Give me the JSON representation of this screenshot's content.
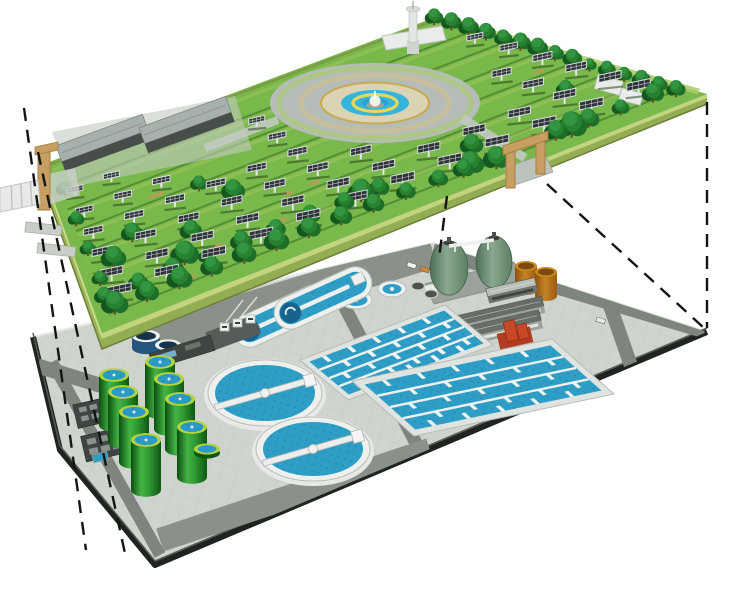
{
  "scene": {
    "width": 740,
    "height": 589,
    "background": "#ffffff",
    "description": "Exploded axonometric illustration of a ground-level park with solar panel arrays, trees and a central fountain plaza sitting above an underground wastewater treatment plant; dashed projection lines connect the two decks."
  },
  "palette": {
    "grass": "#79b84a",
    "grass_stripe": "#2a5a1c",
    "lime": "#a9cb67",
    "hedge_edge": "#7d9b44",
    "wall_top": "#c9da8a",
    "wall_face": "#9db556",
    "wall_front": "#93ad52",
    "wall_shadow": "#6a7f39",
    "panel": "#2e3338",
    "panel_grid": "#c8cdd1",
    "panel_frame": "#d9dde0",
    "panel_post": "#e6e9ea",
    "panel_shadow": "#1e3d14",
    "tree_dark": "#15581f",
    "tree_mid": "#1d6e28",
    "tree_light": "#27822f",
    "tree_top": "#339441",
    "trunk": "#6d4a28",
    "plaza_pave": "#b6bdb9",
    "plaza_inner": "#dbd4b4",
    "plaza_tan": "#c9a94e",
    "plaza_ring": "#cbbf94",
    "water_bright": "#35b5dc",
    "water": "#2f9ec6",
    "water_dark": "#17638c",
    "yellow": "#e9d75a",
    "shed_roof": "#a7b0ac",
    "shed_wall": "#474d49",
    "white_struct": "#e9ece9",
    "struct_stroke": "#c0c6c0",
    "gate_tan": "#c79f63",
    "gate_dark": "#a57e41",
    "pave": "#d0d4cf",
    "road": "#7d857d",
    "apron": "#8a918a",
    "edge_black": "#202420",
    "tank_white": "#eef0ee",
    "navy": "#24567e",
    "navy_top": "#16334d",
    "block_frame": "#e0e4e0",
    "tab": "#f2f4f2",
    "cyl_rim": "#b5d33f",
    "cyl_water": "#2a9ac8",
    "dark_bldg": "#3f4542",
    "skylight": "#98a19c",
    "glint": "#7cc4de",
    "gray_roof": "#676d67",
    "gray_wall": "#9aa19a",
    "red_bldg": "#c84828",
    "red_dark": "#8f3015",
    "machinery_pad": "#565d58",
    "dash": "#141414",
    "tan_rail": "#b99a57",
    "ramp": "#c9cec9",
    "path_gray": "#c3c9c2"
  },
  "upper_level": {
    "label": "surface park with solar farm",
    "platform": {
      "corners": {
        "west": [
          41,
          165
        ],
        "north": [
          436,
          17
        ],
        "east": [
          707,
          94
        ],
        "south": [
          102,
          333
        ]
      },
      "wall_height": 16
    },
    "solar_panels": {
      "rows": [
        0.1,
        0.23,
        0.36,
        0.49,
        0.62,
        0.75,
        0.86
      ],
      "u_start": 0.045,
      "u_end": 0.96,
      "u_step": 0.082,
      "seed": 7
    },
    "exclusions": {
      "plaza_ellipse": {
        "cx": 375,
        "cy": 103,
        "rx": 128,
        "ry": 56
      },
      "rects": [
        [
          46,
          104,
          244,
          180
        ],
        [
          370,
          0,
          460,
          64
        ]
      ]
    },
    "plaza": {
      "cx": 375,
      "cy": 103,
      "outer_rx": 105,
      "outer_ry": 40,
      "hedge_rx": 96,
      "hedge_ry": 35,
      "ring_rx": 74,
      "ring_ry": 28,
      "inner_rx": 54,
      "inner_ry": 20.5,
      "blue_rx": 34,
      "blue_ry": 13,
      "yellow_rx": 22,
      "yellow_ry": 8.4,
      "core_rx": 13,
      "core_ry": 5
    },
    "paths": [
      {
        "x1": 462,
        "y1": 118,
        "x2": 525,
        "y2": 158,
        "w": 9
      },
      {
        "x1": 278,
        "y1": 120,
        "x2": 205,
        "y2": 148,
        "w": 8
      }
    ],
    "sheds": [
      {
        "cx": 105,
        "cy": 146,
        "len": 92,
        "wid": 17,
        "wallH": 10,
        "angle": -20
      },
      {
        "cx": 188,
        "cy": 128,
        "len": 92,
        "wid": 17,
        "wallH": 10,
        "angle": -20
      }
    ],
    "shed_pad": [
      [
        52,
        132
      ],
      [
        235,
        96
      ],
      [
        252,
        150
      ],
      [
        72,
        187
      ]
    ],
    "tower": {
      "base": [
        407,
        40,
        12,
        14
      ],
      "shaft": [
        409,
        10,
        8,
        32
      ],
      "top": [
        413,
        9,
        7,
        3
      ]
    },
    "white_building": [
      [
        382,
        36
      ],
      [
        442,
        26
      ],
      [
        446,
        40
      ],
      [
        386,
        50
      ]
    ],
    "white_boxes": [
      {
        "x": 598,
        "y": 75,
        "w": 26,
        "h": 14,
        "angle": 15
      },
      {
        "x": 622,
        "y": 88,
        "w": 22,
        "h": 12,
        "angle": 15
      }
    ],
    "trees": {
      "back_row": {
        "u": 0.975,
        "v0": 0.03,
        "v1": 0.95,
        "step": 0.065,
        "r": 8
      },
      "left_edge": {
        "u": 0.025,
        "vs": [
          0.2,
          0.38,
          0.56,
          0.74
        ],
        "r": 8
      },
      "front_rows": [
        {
          "v": 0.92,
          "u0": 0.03,
          "u1": 0.66,
          "step": 0.055,
          "r": 11
        },
        {
          "v": 0.92,
          "u0": 0.78,
          "u1": 0.96,
          "step": 0.055,
          "r": 10
        },
        {
          "v": 0.845,
          "u0": 0.02,
          "u1": 0.5,
          "step": 0.06,
          "r": 9
        }
      ],
      "per_row": 3
    },
    "gates": {
      "left": {
        "post": [
          38,
          150,
          12,
          60
        ],
        "cap": [
          [
            35,
            147
          ],
          [
            58,
            142
          ],
          [
            58,
            150
          ],
          [
            35,
            155
          ]
        ]
      },
      "right": {
        "postA": [
          506,
          152,
          9,
          36
        ],
        "postB": [
          536,
          138,
          9,
          36
        ],
        "beam": [
          [
            503,
            146
          ],
          [
            548,
            131
          ],
          [
            548,
            140
          ],
          [
            503,
            155
          ]
        ],
        "ramp": [
          [
            504,
            168
          ],
          [
            545,
            154
          ],
          [
            553,
            172
          ],
          [
            512,
            186
          ]
        ]
      }
    },
    "exit_road": [
      [
        0,
        188
      ],
      [
        38,
        180
      ],
      [
        40,
        204
      ],
      [
        0,
        212
      ]
    ],
    "ramps": [
      {
        "x": 26,
        "y": 222,
        "w": 36,
        "h": 10,
        "angle": 6
      },
      {
        "x": 38,
        "y": 243,
        "w": 38,
        "h": 10,
        "angle": 6
      }
    ],
    "gate_pad": [
      [
        42,
        175
      ],
      [
        75,
        168
      ],
      [
        80,
        195
      ],
      [
        48,
        205
      ]
    ]
  },
  "lower_level": {
    "label": "underground wastewater treatment plant",
    "platform": {
      "corners": [
        [
          33,
          337
        ],
        [
          433,
          243
        ],
        [
          707,
          332
        ],
        [
          155,
          565
        ],
        [
          60,
          450
        ]
      ]
    },
    "roads": [
      {
        "x1": 150,
        "y1": 338,
        "x2": 433,
        "y2": 252,
        "w": 32,
        "kind": "apron"
      },
      {
        "x1": 433,
        "y1": 250,
        "x2": 705,
        "y2": 331,
        "w": 15,
        "kind": "road"
      },
      {
        "x1": 52,
        "y1": 362,
        "x2": 160,
        "y2": 555,
        "w": 12,
        "kind": "road"
      },
      {
        "x1": 38,
        "y1": 366,
        "x2": 125,
        "y2": 393,
        "w": 15,
        "kind": "road"
      },
      {
        "x1": 340,
        "y1": 298,
        "x2": 430,
        "y2": 470,
        "w": 13,
        "kind": "road"
      },
      {
        "x1": 160,
        "y1": 540,
        "x2": 430,
        "y2": 450,
        "w": 24,
        "kind": "apron"
      },
      {
        "x1": 608,
        "y1": 300,
        "x2": 650,
        "y2": 420,
        "w": 14,
        "kind": "road"
      }
    ],
    "oxidation_ditches": [
      {
        "cx": 282,
        "cy": 316,
        "len": 104,
        "wid": 33,
        "angle": -24.5
      },
      {
        "cx": 323,
        "cy": 298,
        "len": 104,
        "wid": 33,
        "angle": -24.5
      }
    ],
    "round_tanks": [
      {
        "cx": 356,
        "cy": 300,
        "rx": 16,
        "ry": 9
      },
      {
        "cx": 392,
        "cy": 289,
        "rx": 14,
        "ry": 8
      }
    ],
    "small_tanks": [
      {
        "cx": 418,
        "cy": 286,
        "rx": 6.5,
        "ry": 4
      },
      {
        "cx": 431,
        "cy": 294,
        "rx": 6.5,
        "ry": 4
      }
    ],
    "clarifiers": [
      {
        "cx": 265,
        "cy": 393,
        "rx": 57,
        "ry": 33,
        "angle": -16
      },
      {
        "cx": 313,
        "cy": 449,
        "rx": 57,
        "ry": 32,
        "angle": -16
      }
    ],
    "aeration_blocks": [
      {
        "origin": [
          300,
          360
        ],
        "longV": [
          145,
          -55
        ],
        "shortV": [
          48,
          40
        ],
        "lanes": 4
      },
      {
        "origin": [
          352,
          381
        ],
        "longV": [
          200,
          -42
        ],
        "shortV": [
          62,
          55
        ],
        "lanes": 4
      }
    ],
    "digesters": {
      "w": 30,
      "h": 50,
      "tops": [
        [
          160,
          362
        ],
        [
          114,
          375
        ],
        [
          169,
          379
        ],
        [
          123,
          392
        ],
        [
          180,
          399
        ],
        [
          134,
          412
        ],
        [
          192,
          427
        ],
        [
          146,
          440
        ]
      ]
    },
    "ring_tank": {
      "cx": 207,
      "cy": 449,
      "rx": 13,
      "ry": 5.5
    },
    "egg_digesters": {
      "pad": [
        [
          424,
          284
        ],
        [
          514,
          262
        ],
        [
          524,
          282
        ],
        [
          434,
          304
        ]
      ],
      "eggs": [
        {
          "cx": 449,
          "cy": 268,
          "rx": 19,
          "ry": 27
        },
        {
          "cx": 494,
          "cy": 262,
          "rx": 18,
          "ry": 26
        }
      ],
      "white_tank": {
        "x": 424,
        "y": 286,
        "w": 14,
        "h": 8
      }
    },
    "storage_tanks": [
      {
        "cx": 526,
        "cy": 266,
        "w": 22,
        "h": 24
      },
      {
        "cx": 546,
        "cy": 272,
        "w": 22,
        "h": 24
      }
    ],
    "buildings": {
      "g2": {
        "cx": 512,
        "cy": 291,
        "len": 50,
        "wid": 8,
        "wallH": 7,
        "angle": -13
      },
      "g1a": {
        "cx": 500,
        "cy": 316,
        "len": 90,
        "wid": 10,
        "wallH": 7,
        "angle": -13
      },
      "g1b": {
        "cx": 495,
        "cy": 331,
        "len": 95,
        "wid": 11,
        "wallH": 8,
        "angle": -13
      },
      "red": {
        "base": [
          515,
          338,
          34,
          16
        ],
        "t1": [
          507,
          320,
          11,
          20
        ],
        "t2": [
          519,
          326,
          10,
          15
        ],
        "angle": -13
      },
      "d1": {
        "cx": 96,
        "cy": 412,
        "len": 42,
        "wid": 24,
        "angle": -13
      },
      "d2": {
        "cx": 106,
        "cy": 444,
        "len": 46,
        "wid": 26,
        "angle": -13
      },
      "pool": {
        "x": 92,
        "y": 455,
        "w": 15,
        "h": 8,
        "angle": -13
      },
      "shed": {
        "cx": 182,
        "cy": 352,
        "len": 64,
        "wid": 16,
        "angle": -17
      }
    },
    "machinery": {
      "pad": {
        "cx": 233,
        "cy": 333,
        "len": 52,
        "wid": 20,
        "angle": -20
      },
      "hoppers": [
        [
          220,
          323
        ],
        [
          233,
          319
        ],
        [
          246,
          315
        ]
      ],
      "masts": [
        [
          226,
          322,
          243,
          300
        ],
        [
          240,
          318,
          257,
          297
        ]
      ],
      "navy_tanks": [
        {
          "cx": 146,
          "cy": 336,
          "rx": 14,
          "h": 12
        },
        {
          "cx": 168,
          "cy": 345,
          "rx": 13,
          "h": 11
        }
      ]
    },
    "cars": [
      {
        "x": 408,
        "y": 262,
        "c": "#f4f4f2"
      },
      {
        "x": 421,
        "y": 266,
        "c": "#cc8833"
      },
      {
        "x": 597,
        "y": 317,
        "c": "#e8e8e8"
      }
    ]
  },
  "projection_lines": {
    "dash": "13 9",
    "width": 2.4,
    "lines": [
      {
        "x1": 24,
        "y1": 108,
        "x2": 86,
        "y2": 550
      },
      {
        "x1": 38,
        "y1": 152,
        "x2": 126,
        "y2": 558
      },
      {
        "x1": 707,
        "y1": 102,
        "x2": 707,
        "y2": 328
      },
      {
        "x1": 547,
        "y1": 184,
        "x2": 704,
        "y2": 328
      },
      {
        "x1": 447,
        "y1": 196,
        "x2": 439,
        "y2": 258
      }
    ]
  }
}
